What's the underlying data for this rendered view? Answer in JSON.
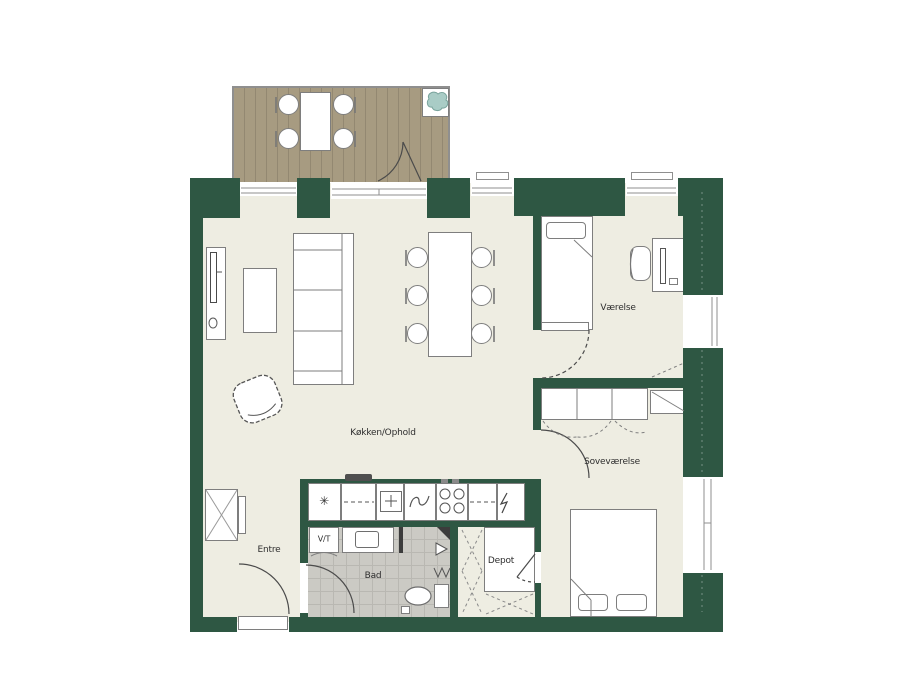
{
  "floorplan": {
    "rooms": {
      "kitchen_living": {
        "label": "Køkken/Ophold"
      },
      "room": {
        "label": "Værelse"
      },
      "bedroom": {
        "label": "Soveværelse"
      },
      "entry": {
        "label": "Entre"
      },
      "bathroom": {
        "label": "Bad"
      },
      "storage": {
        "label": "Depot"
      },
      "washer_dryer": {
        "label": "V/T"
      }
    },
    "icons": {
      "freezer": "✳"
    },
    "colors": {
      "wall_green": "#2e5743",
      "floor_cream": "#eeede2",
      "balcony_deck": "#a79b81",
      "bathroom_tile": "#cbcac4",
      "plant_teal": "#a9ccc6",
      "furniture_outline": "#7e7e7e"
    }
  }
}
